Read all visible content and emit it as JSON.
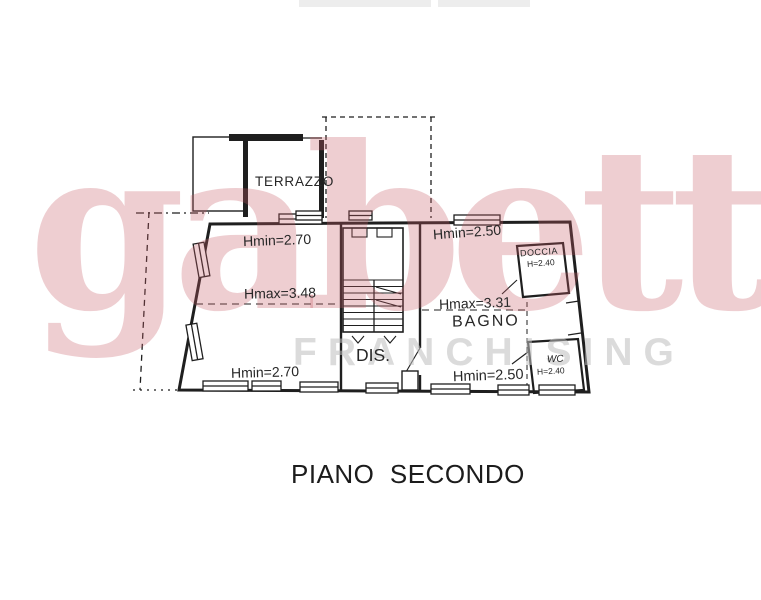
{
  "watermark": {
    "brand": "gabetti",
    "subtitle": "FRANCHISING",
    "brand_color": "#c65c67",
    "subtitle_color": "#bebebe"
  },
  "plan": {
    "title": "PIANO  SECONDO",
    "line_color": "#1f1f1f",
    "rooms": {
      "terrazzo": {
        "label": "TERRAZZO"
      },
      "disimpegno": {
        "label": "DIS."
      },
      "bagno": {
        "label": "BAGNO"
      },
      "doccia": {
        "label": "DOCCIA",
        "height": "H=2.40"
      },
      "wc": {
        "label": "WC",
        "height": "H=2.40"
      }
    },
    "measurements": {
      "main_room": {
        "hmin_top": "Hmin=2.70",
        "hmax": "Hmax=3.48",
        "hmin_bottom": "Hmin=2.70"
      },
      "bagno": {
        "hmin_top": "Hmin=2.50",
        "hmax": "Hmax=3.31",
        "hmin_bottom": "Hmin=2.50"
      }
    }
  }
}
